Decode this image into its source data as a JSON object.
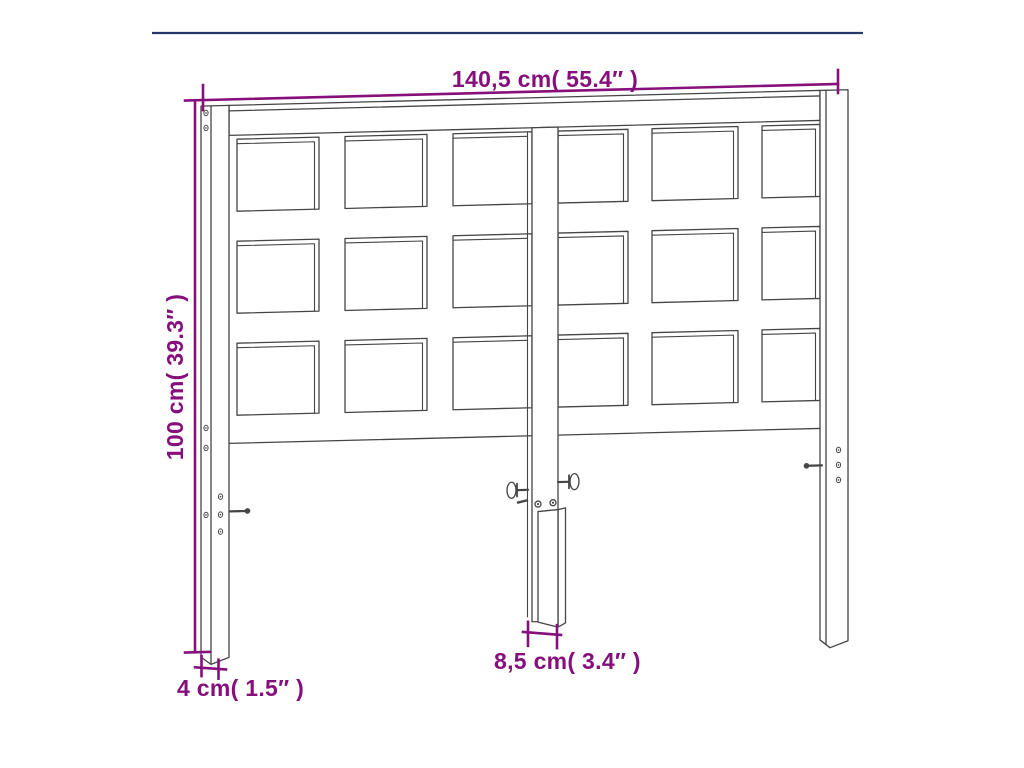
{
  "page": {
    "background": "#ffffff",
    "top_rule_color": "#24386b"
  },
  "diagram": {
    "subject": "headboard dimension drawing",
    "line_color": "#454545",
    "dimension_color": "#850f7b",
    "grid": {
      "rows": 3,
      "columns": 6
    },
    "labels": {
      "width": "140,5 cm( 55.4″ )",
      "height": "100 cm( 39.3″ )",
      "post_thickness": "4 cm( 1.5″ )",
      "leg_width": "8,5 cm( 3.4″ )"
    }
  }
}
